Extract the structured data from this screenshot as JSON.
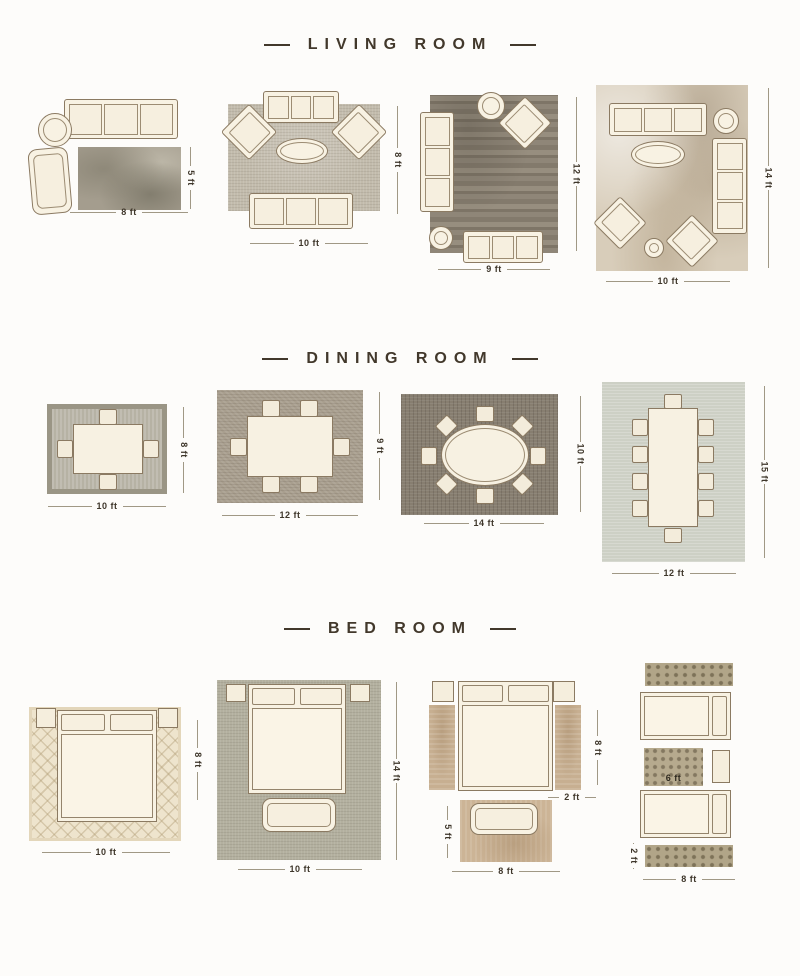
{
  "sections": [
    {
      "title": "LIVING ROOM",
      "layouts": [
        {
          "name": "sofa-and-armchair",
          "width": "8 ft",
          "height": "5 ft"
        },
        {
          "name": "two-sofas-two-armchairs",
          "width": "10 ft",
          "height": "8 ft"
        },
        {
          "name": "sofa-chaise-and-armchair",
          "width": "9 ft",
          "height": "12 ft"
        },
        {
          "name": "full-seating-group",
          "width": "10 ft",
          "height": "14 ft"
        }
      ]
    },
    {
      "title": "DINING ROOM",
      "layouts": [
        {
          "name": "table-four-chairs",
          "width": "10 ft",
          "height": "8 ft"
        },
        {
          "name": "table-six-chairs",
          "width": "12 ft",
          "height": "9 ft"
        },
        {
          "name": "oval-table-eight-chairs",
          "width": "14 ft",
          "height": "10 ft"
        },
        {
          "name": "long-table-ten-chairs",
          "width": "12 ft",
          "height": "15 ft"
        }
      ]
    },
    {
      "title": "BED ROOM",
      "layouts": [
        {
          "name": "bed-on-area-rug",
          "width": "10 ft",
          "height": "8 ft"
        },
        {
          "name": "bed-and-bench-on-area-rug",
          "width": "10 ft",
          "height": "14 ft"
        },
        {
          "name": "bed-with-side-runners",
          "runner_length": "8 ft",
          "runner_width": "2 ft",
          "foot_rug_height": "5 ft",
          "foot_rug_width": "8 ft"
        },
        {
          "name": "runners-and-accent-rug",
          "accent_rug": "6 ft",
          "runner_width": "2 ft",
          "runner_length": "8 ft"
        }
      ]
    }
  ]
}
